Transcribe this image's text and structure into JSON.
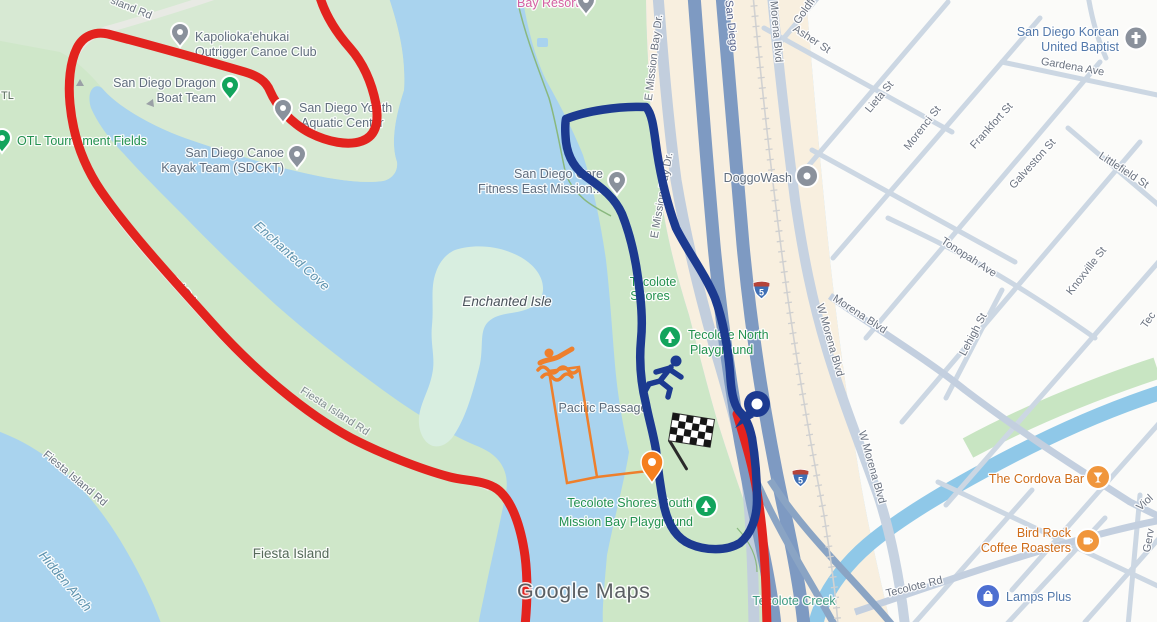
{
  "watermark": "Google Maps",
  "shield": {
    "route_number": "5"
  },
  "colors": {
    "water": "#a9d3ee",
    "land": "#cfe7c9",
    "peninsula": "#d7e9d3",
    "shallow": "#d8eee0",
    "corridor": "#f8efdf",
    "urban": "#fbfbf9",
    "route_red": "#e3231e",
    "route_blue": "#1c3a90",
    "course_orange": "#ee7f2c"
  },
  "poi_labels": [
    {
      "text": "Kapolioka'ehukai"
    },
    {
      "text": "Outrigger Canoe Club"
    },
    {
      "text": "San Diego Dragon"
    },
    {
      "text": "Boat Team"
    },
    {
      "text": "San Diego Youth"
    },
    {
      "text": "Aquatic Center"
    },
    {
      "text": "San Diego Canoe"
    },
    {
      "text": "Kayak Team (SDCKT)"
    },
    {
      "text": "OTL Tournament Fields"
    },
    {
      "text": "San Diego Core"
    },
    {
      "text": "Fitness East Mission..."
    },
    {
      "text": "DoggoWash"
    },
    {
      "text": "San Diego Korean"
    },
    {
      "text": "United Baptist"
    },
    {
      "text": "The Cordova Bar"
    },
    {
      "text": "Bird Rock"
    },
    {
      "text": "Coffee Roasters"
    },
    {
      "text": "Lamps Plus"
    },
    {
      "text": "Bay Resort"
    },
    {
      "text": "Tecolote"
    },
    {
      "text": "Shores"
    },
    {
      "text": "Tecolote North"
    },
    {
      "text": "Playground"
    },
    {
      "text": "Tecolote Shores South"
    },
    {
      "text": "Mission Bay Playground"
    },
    {
      "text": "Fiesta Island"
    },
    {
      "text": "TL"
    }
  ],
  "street_labels": [
    {
      "text": "sland Rd"
    },
    {
      "text": "Fiesta Island Rd"
    },
    {
      "text": "nd Rd"
    },
    {
      "text": "Fiesta Island Rd"
    },
    {
      "text": "E Mission Bay Dr."
    },
    {
      "text": "E Mission Bay Dr."
    },
    {
      "text": "San Diego"
    },
    {
      "text": "Morena Blvd"
    },
    {
      "text": "W Morena Blvd"
    },
    {
      "text": "Morena Blvd"
    },
    {
      "text": "W Morena Blvd"
    },
    {
      "text": "Asher St"
    },
    {
      "text": "Goldfi"
    },
    {
      "text": "Lieta St"
    },
    {
      "text": "Gardena Ave"
    },
    {
      "text": "Morenci St"
    },
    {
      "text": "Frankfort St"
    },
    {
      "text": "Littlefield St"
    },
    {
      "text": "Galveston St"
    },
    {
      "text": "Tonopah Ave"
    },
    {
      "text": "Knoxville St"
    },
    {
      "text": "Lehigh St"
    },
    {
      "text": "Tecolote Rd"
    },
    {
      "text": "Tec"
    },
    {
      "text": "Viol"
    },
    {
      "text": "Gerv"
    }
  ],
  "water_labels": [
    {
      "text": "Enchanted Cove"
    },
    {
      "text": "Enchanted Isle"
    },
    {
      "text": "Hidden Anch"
    },
    {
      "text": "Tecolote Creek"
    },
    {
      "text": "Pacific Passage"
    }
  ]
}
